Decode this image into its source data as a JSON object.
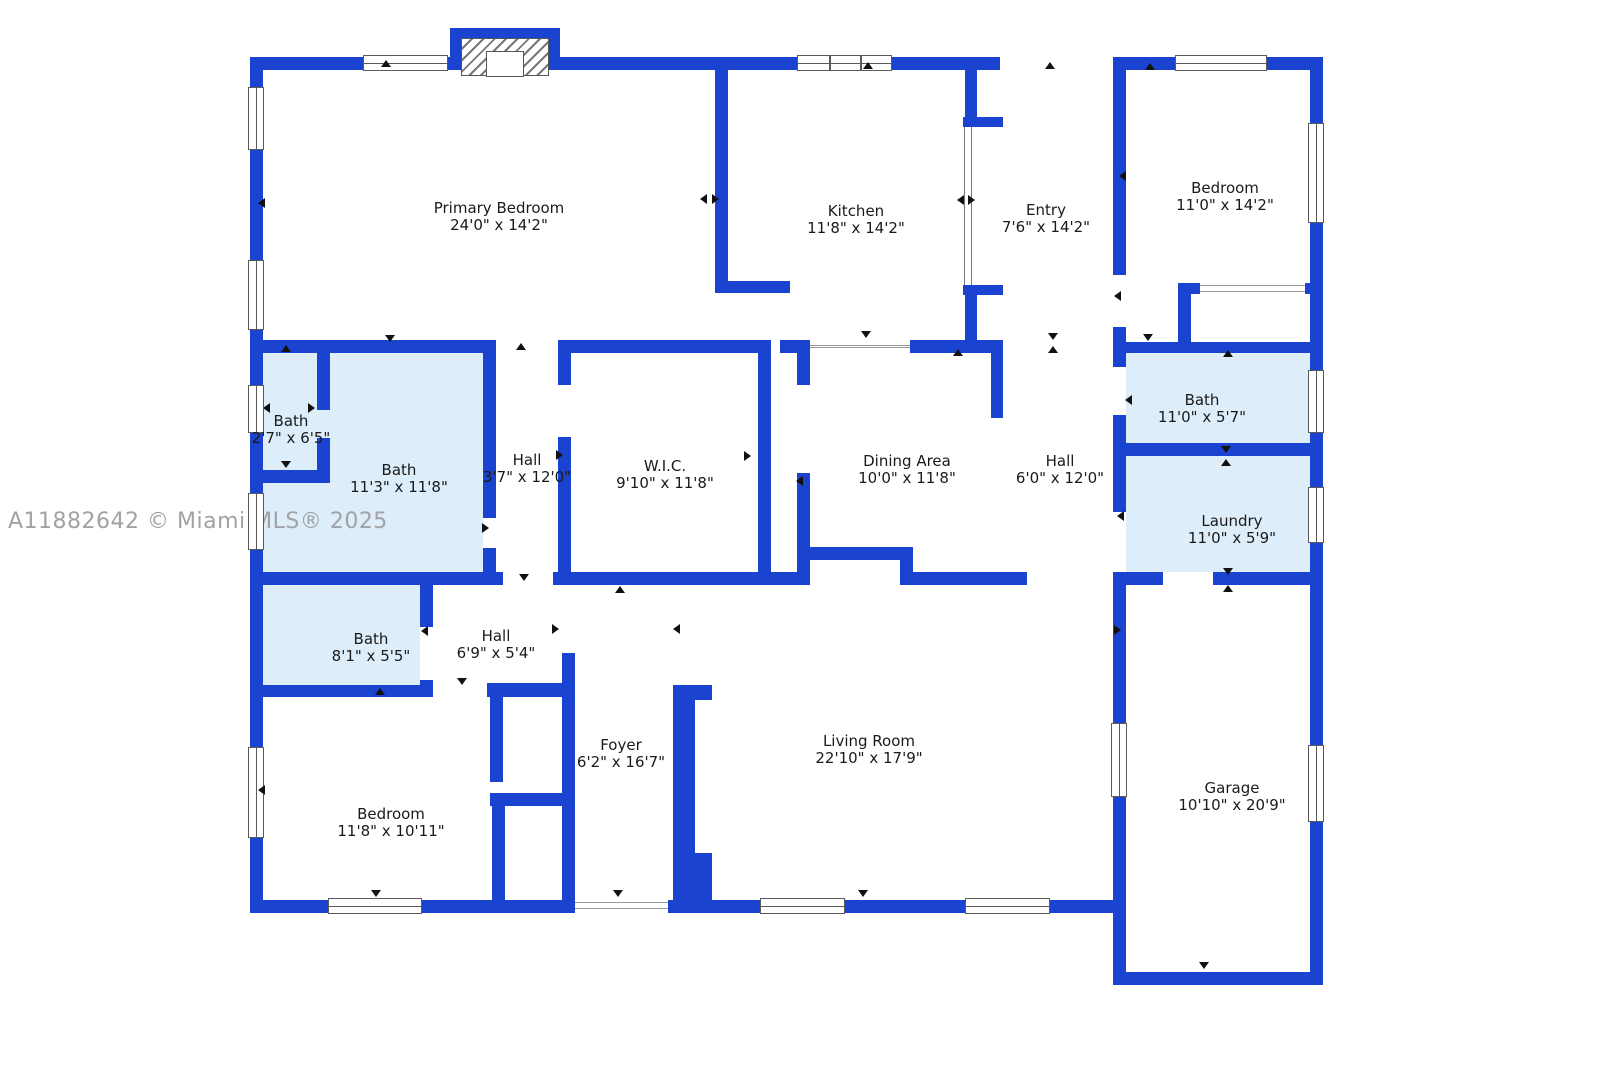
{
  "watermark": "A11882642 © Miami MLS® 2025",
  "colors": {
    "wall": "#1a43cf",
    "bath_fill": "#ddedf9",
    "label_text": "#1a1a1a",
    "watermark_text": "#a2a2a6",
    "window_frame": "#5a5a5a",
    "door_marker": "#111111"
  },
  "rooms": [
    {
      "name": "Primary Bedroom",
      "dims": "24'0\" x 14'2\""
    },
    {
      "name": "Kitchen",
      "dims": "11'8\" x 14'2\""
    },
    {
      "name": "Entry",
      "dims": "7'6\" x 14'2\""
    },
    {
      "name": "Bedroom",
      "dims": "11'0\" x 14'2\""
    },
    {
      "name": "Bath",
      "dims": "2'7\" x 6'5\""
    },
    {
      "name": "Bath",
      "dims": "11'3\" x 11'8\""
    },
    {
      "name": "Hall",
      "dims": "3'7\" x 12'0\""
    },
    {
      "name": "W.I.C.",
      "dims": "9'10\" x 11'8\""
    },
    {
      "name": "Dining Area",
      "dims": "10'0\" x 11'8\""
    },
    {
      "name": "Hall",
      "dims": "6'0\" x 12'0\""
    },
    {
      "name": "Bath",
      "dims": "11'0\" x 5'7\""
    },
    {
      "name": "Laundry",
      "dims": "11'0\" x 5'9\""
    },
    {
      "name": "Bath",
      "dims": "8'1\" x 5'5\""
    },
    {
      "name": "Hall",
      "dims": "6'9\" x 5'4\""
    },
    {
      "name": "Bedroom",
      "dims": "11'8\" x 10'11\""
    },
    {
      "name": "Foyer",
      "dims": "6'2\" x 16'7\""
    },
    {
      "name": "Living Room",
      "dims": "22'10\" x 17'9\""
    },
    {
      "name": "Garage",
      "dims": "10'10\" x 20'9\""
    }
  ]
}
